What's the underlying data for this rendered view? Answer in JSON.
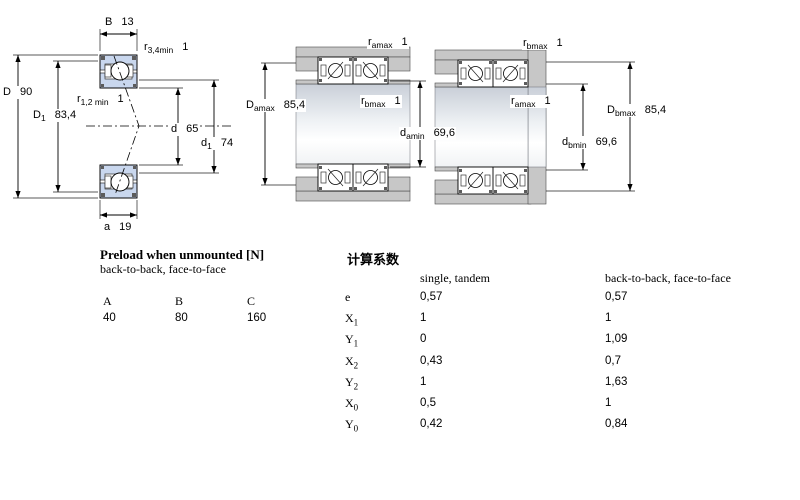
{
  "diagrams": {
    "cross_section": {
      "labels": {
        "B": {
          "sym": "B",
          "sub": "",
          "value": "13"
        },
        "r34": {
          "sym": "r",
          "sub": "3,4min",
          "value": "1"
        },
        "D": {
          "sym": "D",
          "sub": "",
          "value": "90"
        },
        "D1": {
          "sym": "D",
          "sub": "1",
          "value": "83,4"
        },
        "r12": {
          "sym": "r",
          "sub": "1,2 min",
          "value": "1"
        },
        "d": {
          "sym": "d",
          "sub": "",
          "value": "65"
        },
        "d1": {
          "sym": "d",
          "sub": "1",
          "value": "74"
        },
        "a": {
          "sym": "a",
          "sub": "",
          "value": "19"
        }
      }
    },
    "mount_a": {
      "labels": {
        "r_amax": {
          "sym": "r",
          "sub": "amax",
          "value": "1"
        },
        "D_amax": {
          "sym": "D",
          "sub": "amax",
          "value": "85,4"
        },
        "r_bmax": {
          "sym": "r",
          "sub": "bmax",
          "value": "1"
        },
        "d_amin": {
          "sym": "d",
          "sub": "amin",
          "value": "69,6"
        }
      }
    },
    "mount_b": {
      "labels": {
        "r_bmax": {
          "sym": "r",
          "sub": "bmax",
          "value": "1"
        },
        "r_amax": {
          "sym": "r",
          "sub": "amax",
          "value": "1"
        },
        "d_bmin": {
          "sym": "d",
          "sub": "bmin",
          "value": "69,6"
        },
        "D_bmax": {
          "sym": "D",
          "sub": "bmax",
          "value": "85,4"
        }
      }
    }
  },
  "preload_table": {
    "title": "Preload when unmounted [N]",
    "subtitle": "back-to-back, face-to-face",
    "columns": [
      "A",
      "B",
      "C"
    ],
    "values": [
      "40",
      "80",
      "160"
    ]
  },
  "calc_table": {
    "title": "计算系数",
    "col1_header": "single, tandem",
    "col2_header": "back-to-back, face-to-face",
    "rows": [
      {
        "sym": "e",
        "sub": "",
        "single": "0,57",
        "btb": "0,57"
      },
      {
        "sym": "X",
        "sub": "1",
        "single": "1",
        "btb": "1"
      },
      {
        "sym": "Y",
        "sub": "1",
        "single": "0",
        "btb": "1,09"
      },
      {
        "sym": "X",
        "sub": "2",
        "single": "0,43",
        "btb": "0,7"
      },
      {
        "sym": "Y",
        "sub": "2",
        "single": "1",
        "btb": "1,63"
      },
      {
        "sym": "X",
        "sub": "0",
        "single": "0,5",
        "btb": "1"
      },
      {
        "sym": "Y",
        "sub": "0",
        "single": "0,42",
        "btb": "0,84"
      }
    ]
  },
  "colors": {
    "bearing_blue": "#c9d7ee",
    "steel_gray": "#c7c7c7",
    "line_black": "#000000"
  }
}
